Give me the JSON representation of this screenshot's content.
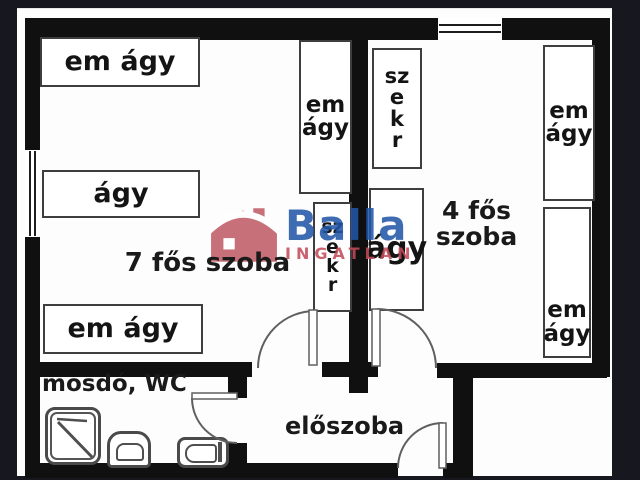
{
  "labels": {
    "room7": "7 fős szoba",
    "room4": [
      "4 fős",
      "szoba"
    ],
    "bathroom": "mosdó, WC",
    "hallway": "előszoba"
  },
  "furniture": {
    "r7_bed_top": "em ágy",
    "r7_bed_mid": "ágy",
    "r7_bed_bottom": "em ágy",
    "r7_bunk_side": [
      "em",
      "ágy"
    ],
    "r7_wardrobe": [
      "sz",
      "e",
      "k",
      "r"
    ],
    "r4_wardrobe": [
      "sz",
      "e",
      "k",
      "r"
    ],
    "r4_bed": "ágy",
    "r4_bunk_top": [
      "em",
      "ágy"
    ],
    "r4_bunk_bottom": [
      "em",
      "ágy"
    ]
  },
  "watermark": {
    "brand": "Balla",
    "subtitle": "INGATLAN"
  },
  "colors": {
    "wall": "#101010",
    "furniture_border": "#3e3e3e",
    "fixture_border": "#4a4a4a",
    "brand_blue": "#2257a7",
    "brand_red": "#c34b58",
    "house_red": "#c05c66",
    "frame_dark": "#171720"
  }
}
